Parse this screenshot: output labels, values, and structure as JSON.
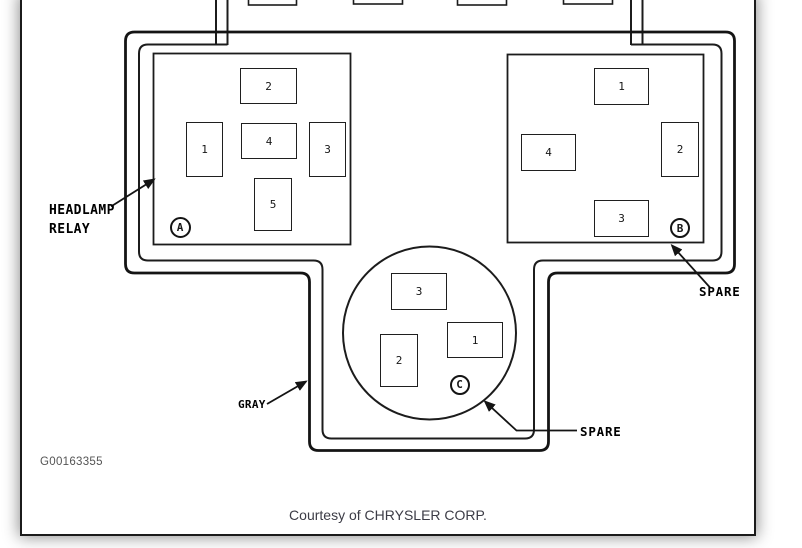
{
  "page": {
    "figure_id": "G00163355",
    "caption": "Courtesy of CHRYSLER CORP."
  },
  "colors": {
    "ink": "#161616",
    "page_border": "#1b1b1b",
    "figure_id_text": "#545454",
    "caption_text": "#3c3c46"
  },
  "labels": {
    "headlamp_relay": "HEADLAMP\nRELAY",
    "gray": "GRAY",
    "spare_b": "SPARE",
    "spare_c": "SPARE"
  },
  "connectors": {
    "a": {
      "designator": "A",
      "pins": [
        "2",
        "1",
        "4",
        "3",
        "5"
      ]
    },
    "b": {
      "designator": "B",
      "pins": [
        "1",
        "4",
        "2",
        "3"
      ]
    },
    "c": {
      "designator": "C",
      "pins": [
        "3",
        "2",
        "1"
      ]
    }
  }
}
